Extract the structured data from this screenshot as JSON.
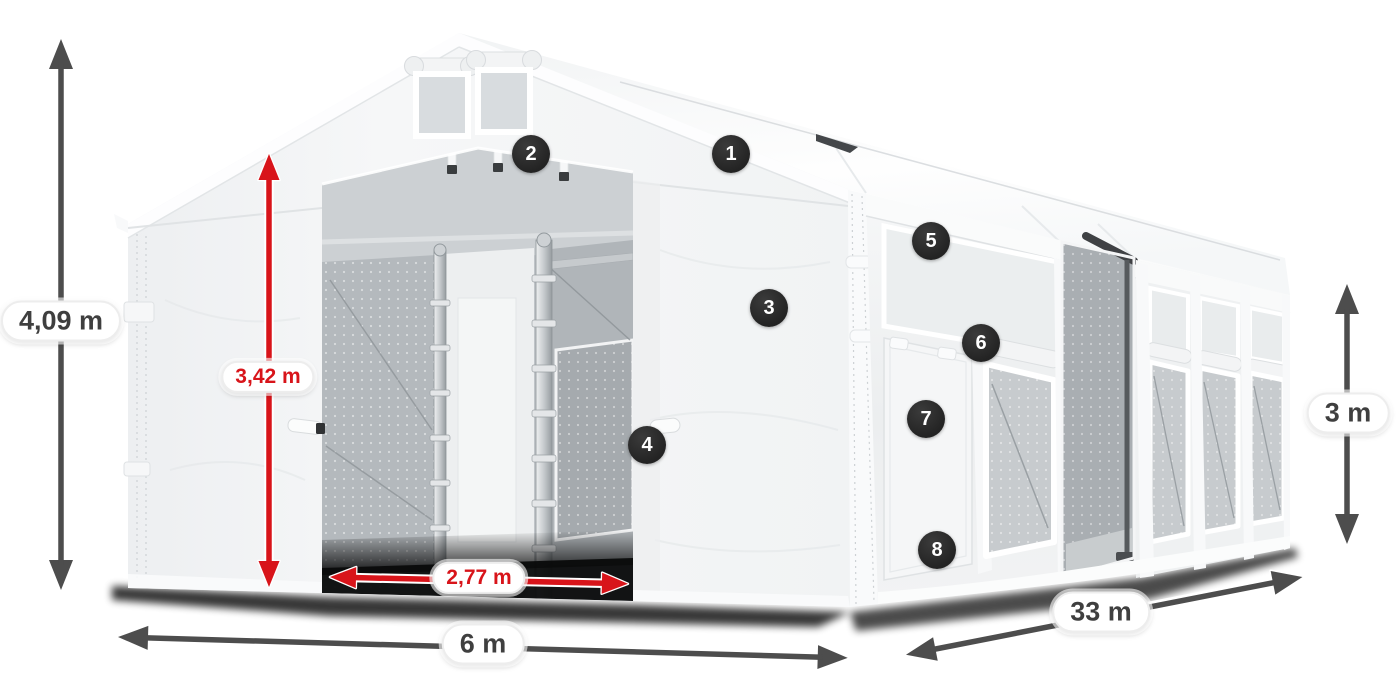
{
  "diagram": {
    "subject": "tent-dimension-diagram",
    "dimensions": [
      {
        "id": "total-height",
        "label": "4,09 m",
        "style": "dark",
        "orientation": "vertical"
      },
      {
        "id": "inner-height",
        "label": "3,42 m",
        "style": "red",
        "orientation": "vertical"
      },
      {
        "id": "entrance-width",
        "label": "2,77 m",
        "style": "red",
        "orientation": "horizontal"
      },
      {
        "id": "front-width",
        "label": "6 m",
        "style": "dark",
        "orientation": "horizontal"
      },
      {
        "id": "side-length",
        "label": "33 m",
        "style": "dark",
        "orientation": "diagonal"
      },
      {
        "id": "side-height",
        "label": "3 m",
        "style": "dark",
        "orientation": "vertical"
      }
    ],
    "callouts": [
      {
        "number": "1"
      },
      {
        "number": "2"
      },
      {
        "number": "3"
      },
      {
        "number": "4"
      },
      {
        "number": "5"
      },
      {
        "number": "6"
      },
      {
        "number": "7"
      },
      {
        "number": "8"
      }
    ],
    "colors": {
      "canvas_background": "#ffffff",
      "dimension_dark": "#4d4d4d",
      "dimension_red": "#d8141a",
      "badge_background": "#252525",
      "badge_text": "#ffffff",
      "tent_fabric": "#f4f5f6",
      "interior_gray": "#b7bcc0"
    }
  }
}
